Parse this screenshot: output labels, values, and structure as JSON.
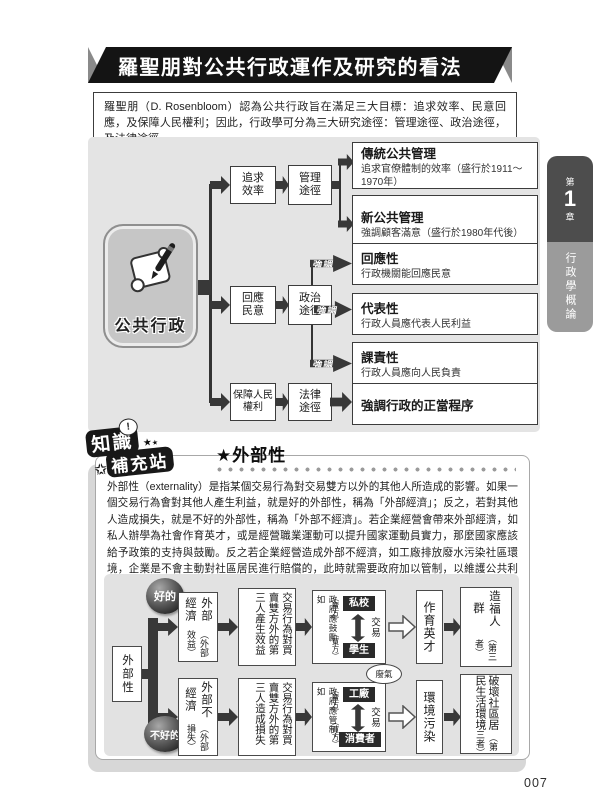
{
  "banner": {
    "title": "羅聖朋對公共行政運作及研究的看法"
  },
  "intro": {
    "text": "羅聖朋（D. Rosenbloom）認為公共行政旨在滿足三大目標：追求效率、民意回應，及保障人民權利；因此，行政學可分為三大研究途徑：管理途徑、政治途徑，及法律途徑。"
  },
  "tab": {
    "chapter_prefix": "第",
    "chapter_number": "1",
    "chapter_suffix": "章",
    "title": "行政學概論"
  },
  "flow": {
    "root": "公共行政",
    "rows": [
      {
        "goal": "追求效率",
        "approach": "管理途徑",
        "outcomes": [
          {
            "title": "傳統公共管理",
            "desc": "追求官僚體制的效率（盛行於1911～1970年）"
          },
          {
            "title": "新公共管理",
            "desc": "強調顧客滿意（盛行於1980年代後）"
          }
        ]
      },
      {
        "goal": "回應民意",
        "approach": "政治途徑",
        "arrow_label": "強調",
        "outcomes": [
          {
            "title": "回應性",
            "desc": "行政機關能回應民意"
          },
          {
            "title": "代表性",
            "desc": "行政人員應代表人民利益"
          },
          {
            "title": "課責性",
            "desc": "行政人員應向人民負責"
          }
        ]
      },
      {
        "goal": "保障人民權利",
        "approach": "法律途徑",
        "outcomes": [
          {
            "title": "強調行政的正當程序",
            "desc": ""
          }
        ]
      }
    ]
  },
  "know": {
    "badge": {
      "bubble": "!",
      "line1": "知識",
      "line2": "補充站",
      "star": "★"
    },
    "heading": "★外部性",
    "paragraph": "外部性（externality）是指某個交易行為對交易雙方以外的其他人所造成的影響。如果一個交易行為會對其他人產生利益，就是好的外部性，稱為「外部經濟」；反之，若對其他人造成損失，就是不好的外部性，稱為「外部不經濟」。若企業經營會帶來外部經濟，如私人辦學為社會作育英才，或是經營職業運動可以提升國家運動員實力，那麼國家應該給予政策的支持與鼓勵。反之若企業經營造成外部不經濟，如工廠排放廢水污染社區環境，企業是不會主動對社區居民進行賠償的，此時就需要政府加以管制，以維護公共利益。"
  },
  "ext": {
    "root": "外部性",
    "good_label": "好的",
    "bad_label": "不好的",
    "good": {
      "type": "外部經濟",
      "type_sub": "（外部效益）",
      "effect": "交易行為對買賣雙方外的第三人產生效益",
      "gov": "政府應鼓勵，如",
      "seller_role": "（賣方）",
      "seller": "私校",
      "exchange": "交易",
      "buyer_role": "（買方）",
      "buyer": "學生",
      "result": "作育英才",
      "final": "造福人群",
      "final_sub": "（第三者）"
    },
    "bad": {
      "type": "外部不經濟",
      "type_sub": "（外部損失）",
      "effect": "交易行為對買賣雙方外的第三人造成損失",
      "gov": "政府應管制，如",
      "seller_role": "（賣方）",
      "seller": "工廠",
      "exchange": "交易",
      "buyer_role": "（買方）",
      "buyer": "消費者",
      "bubble": "廢氣",
      "result": "環境污染",
      "final": "破壞社區居民生活環境",
      "final_sub": "（第三者）"
    }
  },
  "page": {
    "number": "007"
  },
  "colors": {
    "banner_bg": "#141414",
    "panel_bg": "#e4e4e4",
    "tab_dark": "#4d4d4d",
    "tab_light": "#9b9b9b",
    "arrow": "#383838"
  }
}
